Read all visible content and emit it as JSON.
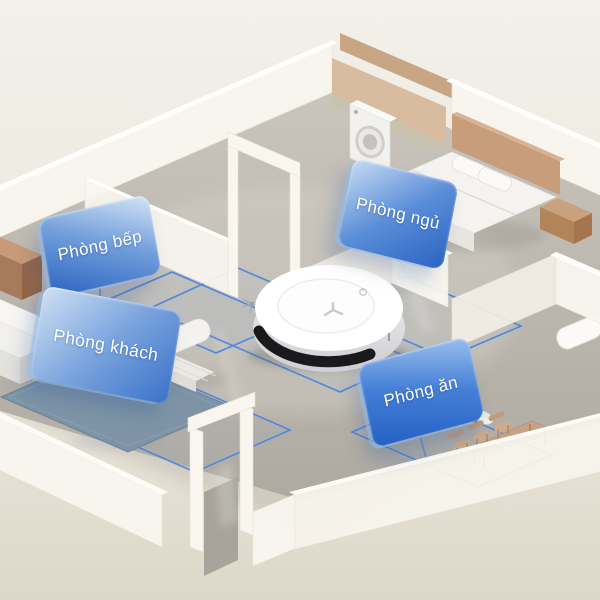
{
  "scene": {
    "description": "Isometric 3D apartment cutaway with a white robot vacuum mapping rooms",
    "device": "robot-vacuum"
  },
  "labels": {
    "kitchen": {
      "text": "Phòng bếp"
    },
    "bedroom": {
      "text": "Phòng ngủ"
    },
    "living": {
      "text": "Phòng khách"
    },
    "dining": {
      "text": "Phòng ăn"
    }
  },
  "icons": {
    "robot_logo": "y-mark",
    "robot_power": "power-dot",
    "washer_door": "round-porthole"
  },
  "colors": {
    "background": "#efece3",
    "floor": "#bcb8af",
    "wall": "#f8f5ee",
    "wood": "#c89f7e",
    "rug": "#7e94a6",
    "zone_line": "#4d80d4",
    "label_gradient_light": "#cfe1f4",
    "label_gradient_dark": "#2160c4",
    "label_text": "#ffffff",
    "robot_body": "#ffffff",
    "robot_bumper": "#1a1a1d"
  }
}
